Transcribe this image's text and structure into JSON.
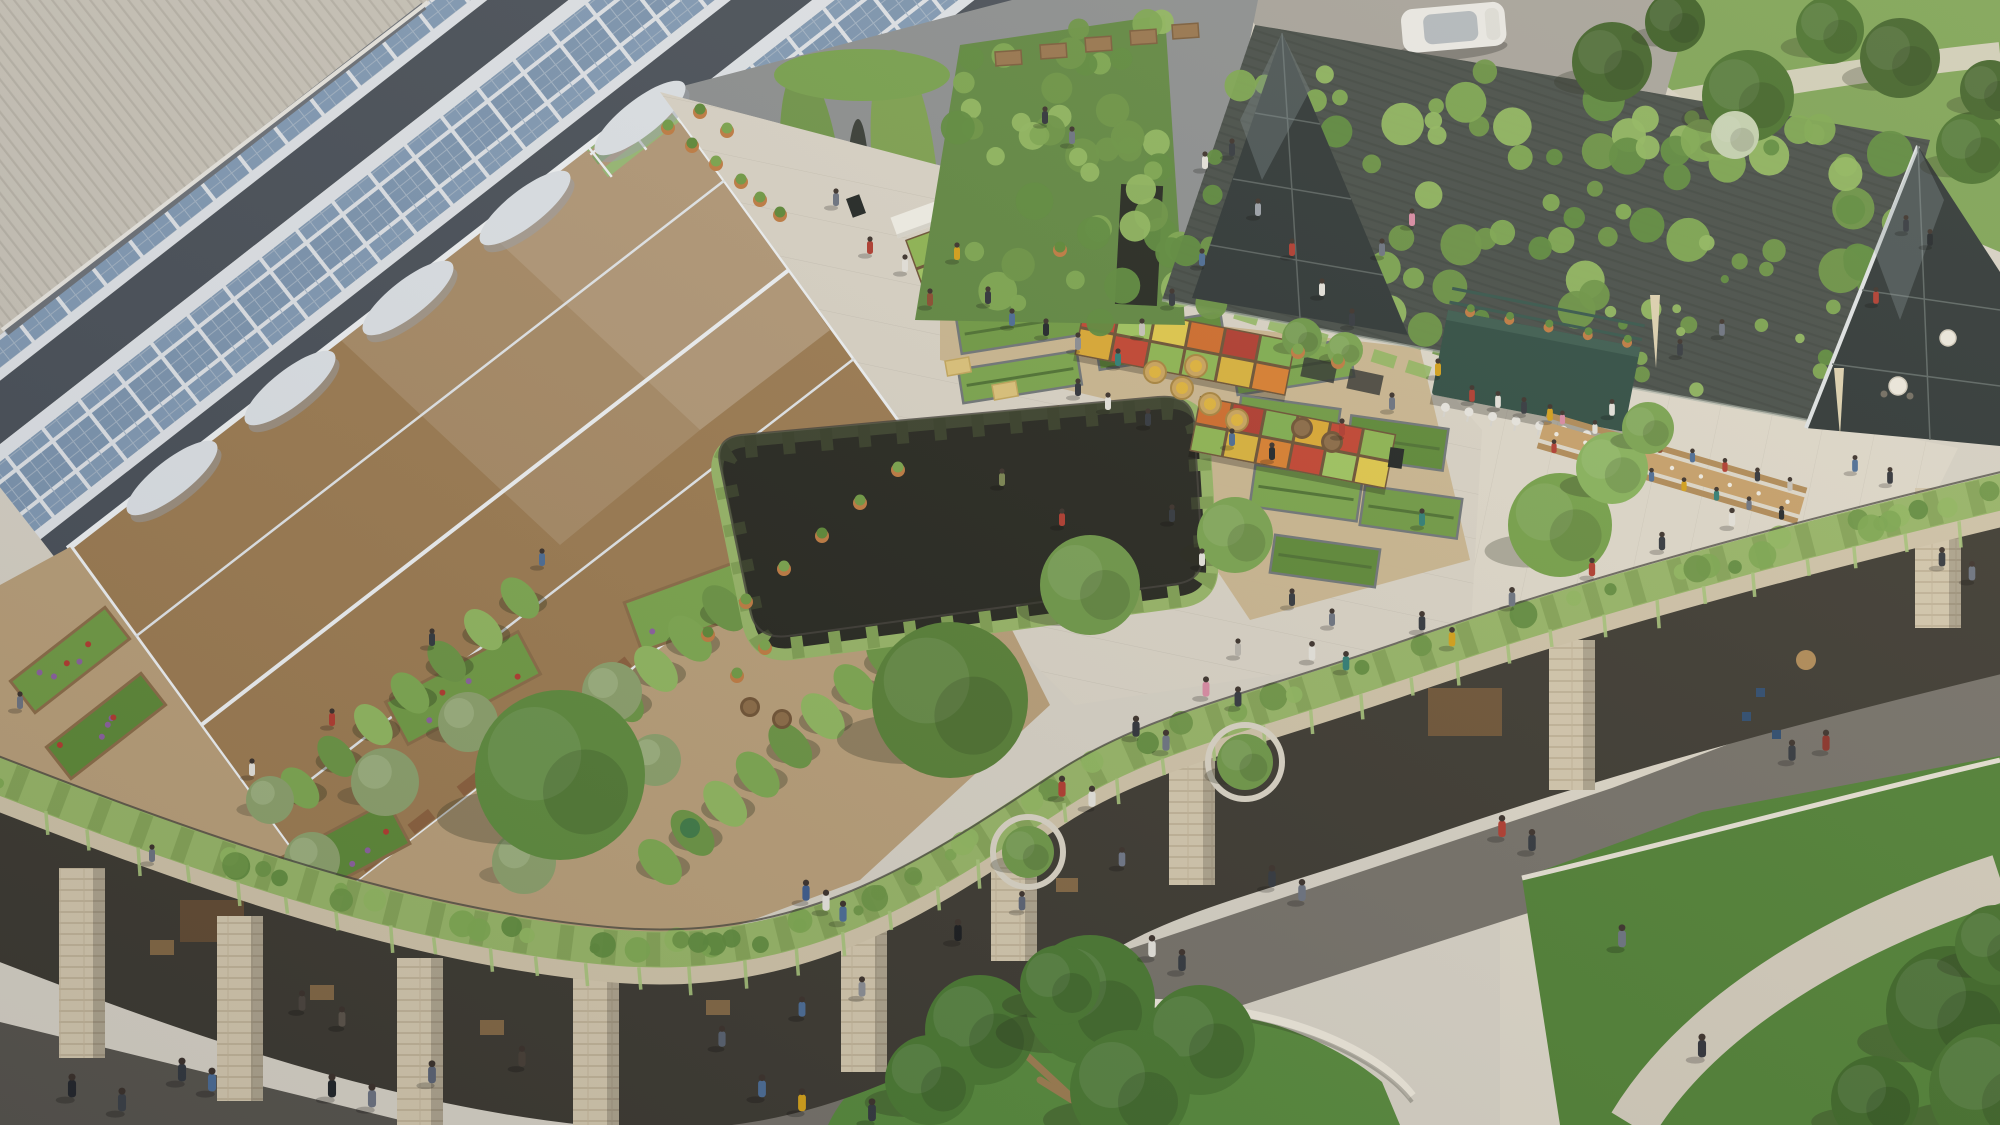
{
  "scene": {
    "description": "Aerial architectural rendering of a sustainable district: sawtooth solar roofs, rooftop greenhouse and urban farm with farmers market, vine-covered barn with terrace dining, sunken courtyard, and a public plaza with lawns and pedestrians",
    "palette": {
      "pavement_light": "#d6d1c5",
      "pavement_warm": "#ded8ca",
      "plaza_roof": "#d9d3c6",
      "pavement_dark": "#747068",
      "pavement_darker": "#56534c",
      "corrugated": "#c8c3b8",
      "solar_frame": "#dfe3e8",
      "solar_panel": "#7b94af",
      "sawtooth_face": "#474e57",
      "greenhouse_frame": "#eff2f4",
      "soil": "#9b7a50",
      "gravel": "#b89e78",
      "bed_gravel": "#c9b48d",
      "hedge": "#96b566",
      "hedge_dark": "#7f9f52",
      "brick": "#cfc3a8",
      "lawn": "#55883a",
      "lawn_bright": "#4f8034",
      "park_grass": "#7ca254",
      "tree_dark": "#3f6128",
      "barn_roof": "#454c47",
      "glass_dark": "#2c3434",
      "kiosk_green": "#2d4b41",
      "wood": "#c7a069",
      "terracotta": "#bf7a40",
      "undercroft": "#3b3830",
      "yard": "#8b8e8f",
      "road": "#a6a29a"
    },
    "regions": [
      "sawtooth-solar-roof",
      "corrugated-roof",
      "rooftop-greenhouse",
      "rooftop-farm-garden",
      "crop-tunnels",
      "olive-grove",
      "raised-beds",
      "farmers-market",
      "sunken-courtyard",
      "vine-covered-barn",
      "glass-gable",
      "kiosk-bar",
      "communal-dining-tables",
      "terrace",
      "parapet-hedge",
      "colonnade",
      "street-plaza",
      "lawns",
      "park",
      "access-road",
      "car"
    ]
  },
  "solar": {
    "rows": 9,
    "y0": -700,
    "pitch": 150
  },
  "greenhouse": {
    "sy0": -344,
    "sy1": 516,
    "spitch": 16,
    "fplong": 36,
    "fpcross": 44,
    "cols": 13
  },
  "crop_greens": [
    "#6f9a43",
    "#5c8836",
    "#79a44b"
  ],
  "vine_greens": [
    "#7ca74f",
    "#8fb65e",
    "#6a9443",
    "#5d8a3c"
  ],
  "garden": {
    "tunnels": [
      {
        "x1": 520,
        "y1": 598,
        "x2": 300,
        "y2": 788,
        "n": 7,
        "r": 24
      },
      {
        "x1": 758,
        "y1": 578,
        "x2": 520,
        "y2": 790,
        "n": 8,
        "r": 27
      },
      {
        "x1": 888,
        "y1": 658,
        "x2": 660,
        "y2": 862,
        "n": 8,
        "r": 27
      }
    ],
    "olives": [
      [
        385,
        782,
        34
      ],
      [
        468,
        722,
        30
      ],
      [
        556,
        800,
        36
      ],
      [
        612,
        692,
        30
      ],
      [
        524,
        862,
        32
      ],
      [
        312,
        860,
        28
      ],
      [
        655,
        760,
        26
      ],
      [
        270,
        800,
        24
      ]
    ],
    "flower_beds": [
      [
        10,
        640,
        120,
        40,
        -38
      ],
      [
        46,
        706,
        120,
        40,
        -38
      ],
      [
        628,
        572,
        170,
        52,
        -20
      ],
      [
        388,
        664,
        150,
        48,
        -28
      ],
      [
        248,
        836,
        160,
        48,
        -28
      ]
    ],
    "barrels": [
      [
        750,
        707
      ],
      [
        782,
        719
      ]
    ]
  },
  "beds": {
    "list": [
      [
        958,
        306,
        128,
        38,
        -9
      ],
      [
        1096,
        322,
        128,
        38,
        -9
      ],
      [
        1234,
        348,
        118,
        38,
        -9
      ],
      [
        1238,
        402,
        100,
        42,
        8
      ],
      [
        1348,
        422,
        98,
        42,
        8
      ],
      [
        1252,
        472,
        108,
        42,
        8
      ],
      [
        1362,
        492,
        98,
        40,
        8
      ],
      [
        1272,
        542,
        106,
        38,
        8
      ],
      [
        960,
        360,
        120,
        34,
        -9
      ]
    ],
    "bales": [
      [
        1005,
        390
      ],
      [
        1048,
        415
      ],
      [
        958,
        366
      ],
      [
        1125,
        466
      ],
      [
        1210,
        518
      ]
    ],
    "wheelbarrow": [
      1088,
      452
    ]
  },
  "market": {
    "stalls": [
      {
        "x": 905,
        "y": 240,
        "w": 128,
        "h": 62,
        "rot": -20,
        "awning": true,
        "rows": 2,
        "cols": 4
      },
      {
        "x": 1085,
        "y": 300,
        "w": 215,
        "h": 56,
        "rot": 11,
        "awning": false,
        "rows": 2,
        "cols": 6
      },
      {
        "x": 1200,
        "y": 396,
        "w": 200,
        "h": 56,
        "rot": 11,
        "awning": false,
        "rows": 2,
        "cols": 6
      }
    ],
    "crate_colors": [
      "#8db551",
      "#d9b23a",
      "#d97e2e",
      "#c24330",
      "#9ec45e",
      "#e0c84a",
      "#cf6b2a",
      "#b03a2e",
      "#7fae4f",
      "#dba832",
      "#c24330",
      "#8db551"
    ],
    "baskets": [
      [
        1155,
        372
      ],
      [
        1182,
        388
      ],
      [
        1210,
        404
      ],
      [
        1237,
        420
      ],
      [
        1196,
        366
      ]
    ],
    "barrels": [
      [
        1302,
        428
      ],
      [
        1332,
        442
      ]
    ],
    "signs": [
      [
        1162,
        276,
        -12
      ],
      [
        1396,
        458,
        8
      ],
      [
        856,
        206,
        -20
      ]
    ]
  },
  "barn": {
    "roof_quad": [
      [
        1255,
        25
      ],
      [
        1930,
        140
      ],
      [
        1848,
        428
      ],
      [
        1162,
        300
      ]
    ],
    "wall_quad": [
      [
        960,
        45
      ],
      [
        1165,
        15
      ],
      [
        1185,
        325
      ],
      [
        915,
        320
      ]
    ],
    "clumps": 115,
    "wall_clumps": 48,
    "crates": [
      [
        995,
        52
      ],
      [
        1040,
        45
      ],
      [
        1085,
        38
      ],
      [
        1130,
        31
      ],
      [
        1172,
        25
      ]
    ]
  },
  "kiosk": {
    "stools": 8,
    "pots": 5
  },
  "table": {
    "x1": 1542,
    "y1": 430,
    "x2": 1802,
    "y2": 506,
    "seat_colors": [
      "#b03a2e",
      "#e5e3dc",
      "#31363d",
      "#4a6b95",
      "#d4a017",
      "#2e7d74",
      "#6b7280",
      "#1f2428",
      "#d98aa3",
      "#e5e3dc",
      "#31363d",
      "#8a4b2e",
      "#4a6b95",
      "#b03a2e",
      "#2e3138",
      "#c7c3bb"
    ]
  },
  "parapet": {
    "piers": [
      [
        82,
        868,
        190
      ],
      [
        240,
        916,
        185
      ],
      [
        420,
        958,
        170
      ],
      [
        596,
        968,
        160
      ],
      [
        864,
        922,
        150
      ],
      [
        1014,
        816,
        145
      ],
      [
        1192,
        750,
        135
      ],
      [
        1572,
        640,
        150
      ],
      [
        1938,
        488,
        140
      ]
    ],
    "drips": 42,
    "clumps": 64
  },
  "courtyard": {
    "vines": 18
  },
  "pots": [
    [
      668,
      128
    ],
    [
      692,
      146
    ],
    [
      716,
      164
    ],
    [
      741,
      182
    ],
    [
      700,
      112
    ],
    [
      727,
      131
    ],
    [
      760,
      200
    ],
    [
      780,
      215
    ],
    [
      898,
      470
    ],
    [
      860,
      503
    ],
    [
      822,
      536
    ],
    [
      784,
      569
    ],
    [
      746,
      602
    ],
    [
      708,
      635
    ],
    [
      765,
      648
    ],
    [
      737,
      676
    ],
    [
      1060,
      250
    ],
    [
      1298,
      352
    ],
    [
      1338,
      362
    ]
  ],
  "trees": [
    [
      560,
      775,
      85,
      "#5d8a3c"
    ],
    [
      950,
      700,
      78,
      "#567f35"
    ],
    [
      1090,
      585,
      50,
      "#6d9747"
    ],
    [
      1235,
      535,
      38,
      "#79a34f"
    ],
    [
      1560,
      525,
      52,
      "#74a048"
    ],
    [
      1612,
      468,
      36,
      "#86b25a"
    ],
    [
      1648,
      428,
      26,
      "#79a34f"
    ],
    [
      1950,
      1010,
      64,
      "#3c6626"
    ],
    [
      1995,
      1090,
      66,
      "#44702c"
    ],
    [
      1875,
      1100,
      44,
      "#3c6626"
    ],
    [
      1995,
      945,
      40,
      "#44702c"
    ],
    [
      1302,
      338,
      20,
      "#6d9747"
    ],
    [
      1345,
      350,
      18,
      "#79a34f"
    ]
  ],
  "park_trees": [
    [
      1612,
      62,
      40,
      "#3f6128"
    ],
    [
      1748,
      96,
      46,
      "#47702c"
    ],
    [
      1900,
      58,
      40,
      "#3f6128"
    ],
    [
      1972,
      148,
      36,
      "#47702c"
    ],
    [
      1675,
      22,
      30,
      "#3a5c24"
    ],
    [
      1830,
      30,
      34,
      "#47702c"
    ],
    [
      1990,
      90,
      30,
      "#3f6128"
    ],
    [
      1735,
      135,
      24,
      "#c2cfae"
    ]
  ],
  "planter_trees": [
    [
      1245,
      762,
      28
    ],
    [
      1028,
      852,
      26
    ]
  ],
  "big_tree": {
    "foliage": [
      [
        980,
        1030,
        55
      ],
      [
        1090,
        1000,
        65
      ],
      [
        1200,
        1040,
        55
      ],
      [
        1130,
        1090,
        60
      ],
      [
        930,
        1080,
        45
      ],
      [
        1060,
        985,
        40
      ]
    ],
    "trunk": [
      [
        1080,
        1105,
        1010,
        1040
      ],
      [
        1080,
        1105,
        1130,
        1030
      ],
      [
        1080,
        1105,
        1180,
        1070
      ],
      [
        1080,
        1105,
        1040,
        1080
      ],
      [
        1080,
        1105,
        1160,
        1100
      ]
    ]
  },
  "people": [
    [
      1045,
      120,
      "#2e3138"
    ],
    [
      1072,
      140,
      "#6b7280"
    ],
    [
      1205,
      165,
      "#e5e3dc"
    ],
    [
      1232,
      152,
      "#31363d"
    ],
    [
      870,
      250,
      "#b03a2e"
    ],
    [
      905,
      268,
      "#e5e3dc"
    ],
    [
      836,
      202,
      "#6b7280"
    ],
    [
      957,
      256,
      "#d4a017"
    ],
    [
      988,
      300,
      "#2e3138"
    ],
    [
      1012,
      322,
      "#4a6b95"
    ],
    [
      1046,
      332,
      "#1f2428"
    ],
    [
      1078,
      346,
      "#8a8d93"
    ],
    [
      1118,
      362,
      "#2e7d74"
    ],
    [
      1142,
      332,
      "#c7c3bb"
    ],
    [
      1172,
      302,
      "#31363d"
    ],
    [
      1202,
      262,
      "#4a6b95"
    ],
    [
      1258,
      212,
      "#9aa0a8"
    ],
    [
      1292,
      252,
      "#b03a2e"
    ],
    [
      1322,
      292,
      "#e5e3dc"
    ],
    [
      1352,
      322,
      "#31363d"
    ],
    [
      1382,
      252,
      "#6b7280"
    ],
    [
      1412,
      222,
      "#d98aa3"
    ],
    [
      930,
      302,
      "#8a4b2e"
    ],
    [
      1078,
      392,
      "#2e3138"
    ],
    [
      1108,
      406,
      "#e5e3dc"
    ],
    [
      1148,
      422,
      "#31363d"
    ],
    [
      1232,
      442,
      "#4a6b95"
    ],
    [
      1272,
      456,
      "#1f2428"
    ],
    [
      1342,
      432,
      "#b03a2e"
    ],
    [
      1392,
      406,
      "#6b7280"
    ],
    [
      1438,
      372,
      "#d4a017"
    ],
    [
      1002,
      482,
      "#7a8550"
    ],
    [
      1062,
      522,
      "#b03a2e"
    ],
    [
      1202,
      562,
      "#e5e3dc"
    ],
    [
      1292,
      602,
      "#31363d"
    ],
    [
      1422,
      522,
      "#2e7d74"
    ],
    [
      1332,
      622,
      "#6b7280"
    ],
    [
      1238,
      652,
      "#b8b4ac"
    ],
    [
      1172,
      518,
      "#31363d"
    ],
    [
      432,
      642,
      "#31363d"
    ],
    [
      332,
      722,
      "#b03a2e"
    ],
    [
      252,
      772,
      "#e5e3dc"
    ],
    [
      152,
      858,
      "#6b7280"
    ],
    [
      542,
      562,
      "#4a6b95"
    ],
    [
      20,
      705,
      "#6b7280"
    ],
    [
      1472,
      398,
      "#b03a2e",
      0.95
    ],
    [
      1498,
      404,
      "#e5e3dc",
      0.95
    ],
    [
      1524,
      410,
      "#31363d",
      0.95
    ],
    [
      1550,
      417,
      "#d4a017",
      0.95
    ],
    [
      1612,
      412,
      "#e5e3dc",
      0.95
    ],
    [
      1680,
      352,
      "#31363d",
      0.95
    ],
    [
      1722,
      332,
      "#6b7280",
      0.95
    ],
    [
      1876,
      300,
      "#b03a2e",
      0.95
    ],
    [
      1906,
      228,
      "#31363d",
      0.95
    ],
    [
      1930,
      242,
      "#1f2428",
      0.95
    ],
    [
      1855,
      468,
      "#4a6b95",
      0.95
    ],
    [
      1890,
      480,
      "#2e3138",
      0.95
    ],
    [
      958,
      936,
      "#17191c",
      1.25
    ],
    [
      806,
      896,
      "#3a5a8c",
      1.2
    ],
    [
      826,
      906,
      "#e5e3dc",
      1.2
    ],
    [
      843,
      917,
      "#4a6b95",
      1.2
    ],
    [
      762,
      1092,
      "#4a6b95",
      1.3
    ],
    [
      802,
      1106,
      "#d4a017",
      1.3
    ],
    [
      872,
      1116,
      "#31363d",
      1.3
    ],
    [
      1062,
      792,
      "#b03a2e",
      1.2
    ],
    [
      1092,
      802,
      "#e5e3dc",
      1.2
    ],
    [
      1136,
      732,
      "#2e3138",
      1.2
    ],
    [
      1166,
      746,
      "#6b7280",
      1.2
    ],
    [
      1206,
      692,
      "#d98aa3",
      1.15
    ],
    [
      1238,
      702,
      "#31363d",
      1.15
    ],
    [
      1312,
      656,
      "#e5e3dc",
      1.1
    ],
    [
      1346,
      666,
      "#2e7d74",
      1.1
    ],
    [
      1422,
      626,
      "#31363d",
      1.1
    ],
    [
      1452,
      642,
      "#d4a017",
      1.1
    ],
    [
      1512,
      602,
      "#6b7280",
      1.1
    ],
    [
      1592,
      572,
      "#b03a2e",
      1.05
    ],
    [
      1662,
      546,
      "#31363d",
      1.05
    ],
    [
      1732,
      522,
      "#e5e3dc",
      1.05
    ],
    [
      1272,
      882,
      "#31363d",
      1.25
    ],
    [
      1302,
      896,
      "#6b7280",
      1.25
    ],
    [
      1152,
      952,
      "#e5e3dc",
      1.25
    ],
    [
      1182,
      966,
      "#31363d",
      1.25
    ],
    [
      1792,
      756,
      "#31363d",
      1.2
    ],
    [
      1826,
      746,
      "#8a2f26",
      1.2
    ],
    [
      1502,
      832,
      "#b03a2e",
      1.25
    ],
    [
      1532,
      846,
      "#31363d",
      1.25
    ],
    [
      1622,
      942,
      "#6b7280",
      1.3
    ],
    [
      1702,
      1052,
      "#2e3138",
      1.35
    ],
    [
      1942,
      562,
      "#31363d",
      1.1
    ],
    [
      1972,
      576,
      "#6b7280",
      1.1
    ],
    [
      182,
      1076,
      "#31363d",
      1.35
    ],
    [
      212,
      1086,
      "#4a6b95",
      1.35
    ],
    [
      332,
      1092,
      "#1f2428",
      1.35
    ],
    [
      372,
      1102,
      "#6b7280",
      1.35
    ],
    [
      72,
      1092,
      "#23262b",
      1.35
    ],
    [
      122,
      1106,
      "#3a3f45",
      1.35
    ],
    [
      432,
      1078,
      "#5a6273",
      1.3
    ],
    [
      302,
      1006,
      "#4a433c",
      1.15
    ],
    [
      342,
      1022,
      "#5a5248",
      1.15
    ],
    [
      522,
      1062,
      "#463e35",
      1.2
    ],
    [
      722,
      1042,
      "#57606e",
      1.2
    ],
    [
      802,
      1012,
      "#4a6b95",
      1.15
    ],
    [
      862,
      992,
      "#8a8d93",
      1.15
    ],
    [
      1022,
      906,
      "#5a6273",
      1.1
    ],
    [
      1122,
      862,
      "#6e7687",
      1.1
    ]
  ]
}
